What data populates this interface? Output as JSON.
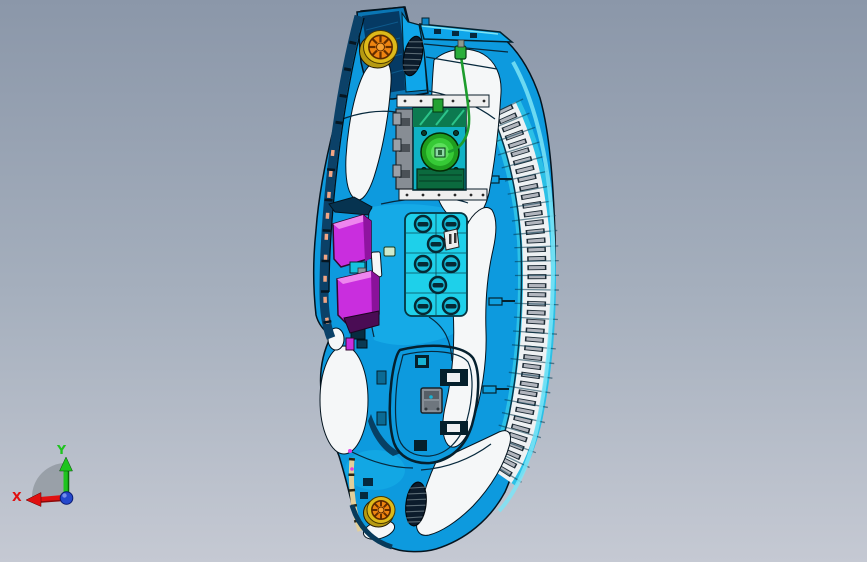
{
  "viewport": {
    "width": 867,
    "height": 562,
    "background_top": "#8b97a9",
    "background_bottom": "#c5c9d3"
  },
  "triad": {
    "x_label": "X",
    "y_label": "Y",
    "x_color": "#e01010",
    "y_color": "#1ec41e",
    "z_color": "#2448cc",
    "arc_color": "#8a9298"
  },
  "model": {
    "name": "instrument-panel-assembly",
    "colors": {
      "body_blue": "#0d9ade",
      "mid_blue": "#16ace8",
      "cyan_panel": "#1ed0ea",
      "pale_cyan": "#7ce4f6",
      "white_surface": "#f5f7f8",
      "outline_dark": "#04141f",
      "navy_frame": "#053a64",
      "magenta_duct": "#c92ede",
      "magenta_light": "#ee86ee",
      "speaker_orange": "#ee8410",
      "speaker_yellow": "#ddba1a",
      "actuator_green": "#36ca36",
      "actuator_base_green": "#0b6a3e",
      "wire_green": "#1d9d2d",
      "bracket_gray": "#878d94",
      "slat_gray": "#b2b6be",
      "salmon_trim": "#f2a584",
      "tan_trim": "#e2cf9a",
      "vent_dark": "#0c1c2c"
    }
  }
}
